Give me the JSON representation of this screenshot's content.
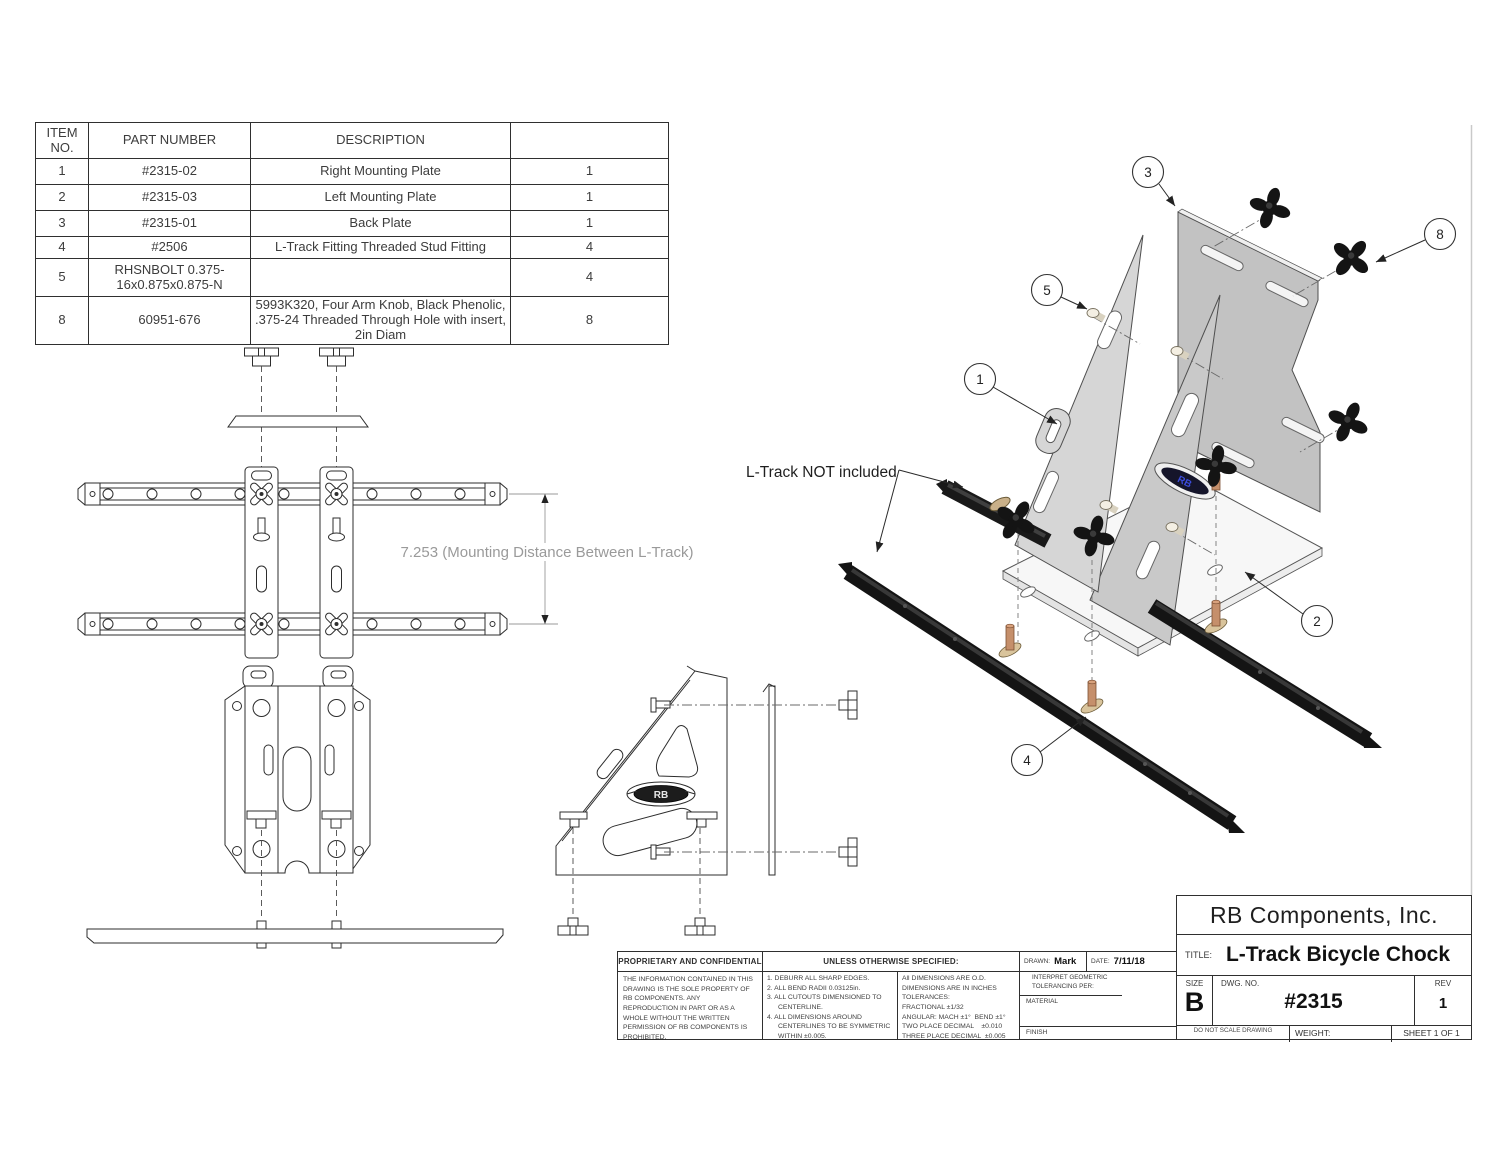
{
  "logo_text": "RB",
  "parts_table": {
    "headers": [
      "ITEM NO.",
      "PART NUMBER",
      "DESCRIPTION",
      ""
    ],
    "rows": [
      {
        "item": "1",
        "part": "#2315-02",
        "desc": "Right Mounting Plate",
        "qty": "1"
      },
      {
        "item": "2",
        "part": "#2315-03",
        "desc": "Left Mounting Plate",
        "qty": "1"
      },
      {
        "item": "3",
        "part": "#2315-01",
        "desc": "Back Plate",
        "qty": "1"
      },
      {
        "item": "4",
        "part": "#2506",
        "desc": "L-Track Fitting Threaded Stud Fitting",
        "qty": "4"
      },
      {
        "item": "5",
        "part": "RHSNBOLT 0.375-16x0.875x0.875-N",
        "desc": "",
        "qty": "4"
      },
      {
        "item": "8",
        "part": "60951-676",
        "desc": "5993K320, Four Arm Knob, Black Phenolic, .375-24 Threaded Through Hole with insert, 2in Diam",
        "qty": "8"
      }
    ]
  },
  "annotations": {
    "dimension": "7.253 (Mounting Distance Between L-Track)",
    "ltrack_note": "L-Track NOT included",
    "balloons": [
      "1",
      "2",
      "3",
      "4",
      "5",
      "8"
    ]
  },
  "notes": {
    "proprietary_title": "PROPRIETARY AND CONFIDENTIAL",
    "proprietary_body": "THE INFORMATION CONTAINED IN THIS DRAWING IS THE SOLE PROPERTY OF RB COMPONENTS.  ANY REPRODUCTION IN PART OR AS A WHOLE WITHOUT THE WRITTEN PERMISSION OF RB COMPONENTS IS PROHIBITED.",
    "unless_title": "UNLESS OTHERWISE SPECIFIED:",
    "unless_items": [
      "1.  DEBURR ALL SHARP EDGES.",
      "2.  ALL BEND RADII 0.03125in.",
      "3.  ALL CUTOUTS DIMENSIONED TO CENTERLINE.",
      "4.  ALL DIMENSIONS AROUND CENTERLINES TO BE SYMMETRIC WITHIN ±0.005."
    ],
    "tolerances": [
      "All DIMENSIONS ARE O.D.",
      "DIMENSIONS ARE IN INCHES",
      "TOLERANCES:",
      "FRACTIONAL ±1/32",
      "ANGULAR: MACH ±1°  BEND ±1°",
      "TWO PLACE DECIMAL    ±0.010",
      "THREE PLACE DECIMAL  ±0.005"
    ]
  },
  "title_block": {
    "company": "RB Components, Inc.",
    "title_label": "TITLE:",
    "title": "L-Track Bicycle Chock",
    "drawn_label": "DRAWN:",
    "drawn": "Mark",
    "date_label": "DATE:",
    "date": "7/11/18",
    "interpret_label": "INTERPRET GEOMETRIC TOLERANCING PER:",
    "material_label": "MATERIAL",
    "finish_label": "FINISH",
    "size_label": "SIZE",
    "size": "B",
    "dwg_label": "DWG. NO.",
    "dwg_no": "#2315",
    "rev_label": "REV",
    "rev": "1",
    "do_not_scale": "DO NOT SCALE DRAWING",
    "weight_label": "WEIGHT:",
    "sheet_label": "SHEET 1 OF 1"
  },
  "colors": {
    "line": "#2d2d2d",
    "dimension_gray": "#9a9a9a",
    "plate_gray_light": "#d6d6d6",
    "plate_gray": "#c2c2c2",
    "knob_black": "#141414",
    "stud_brass": "#c58f6b",
    "pad_tan": "#d9c49c",
    "logo_blue": "#3b4bd8",
    "base_white": "#f7f7f7"
  }
}
